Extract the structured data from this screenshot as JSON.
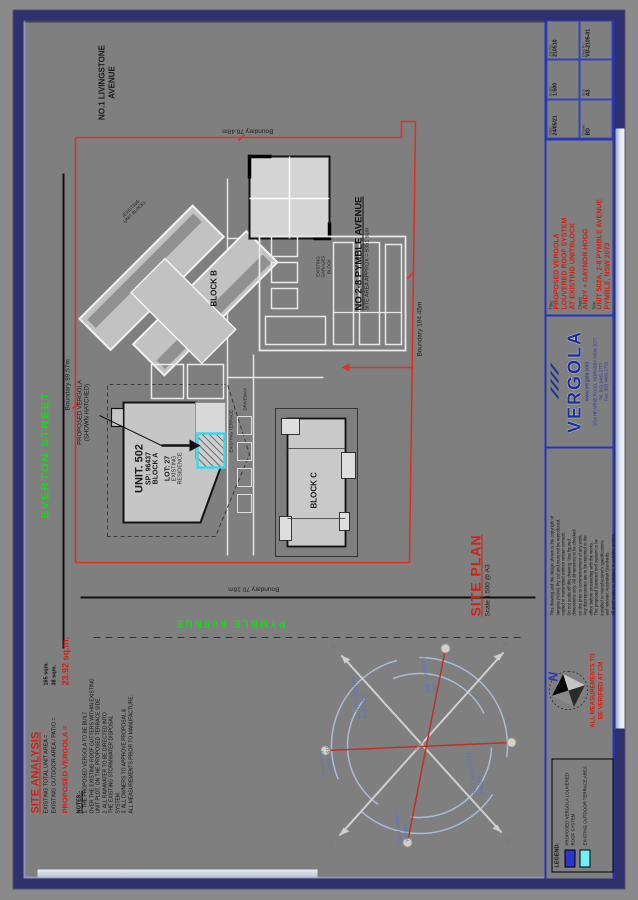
{
  "colors": {
    "red": "#d42015",
    "green": "#17d817",
    "blue": "#2b35c8",
    "cyan": "#49e4f2",
    "navy": "#2e3070"
  },
  "streets": {
    "everton": "EVERTON STREET",
    "pymble": "PYMBLE AVENUE",
    "livingstone_lines": [
      "NO.1 LIVINGSTONE",
      "AVENUE"
    ]
  },
  "boundaries": {
    "top": "Boundary 99.57m",
    "right": "Boundary 76.48m",
    "left": "Boundary 70.16m",
    "bottom": "Boundary 104.45m"
  },
  "plan": {
    "neighbor_title": "NO 2-8 PYMBLE AVENUE",
    "neighbor_sub": "SITE AREA APPROX = 9351 sqm",
    "block_b": "BLOCK B",
    "block_b_sub_lines": [
      "(EXISTING",
      "UNIT BLOCK)"
    ],
    "block_c": "BLOCK C",
    "unit_no": "UNIT. 502",
    "sp": "SP: 96437",
    "block_a": "BLOCK A",
    "lot": "LOT: 27",
    "existing_res_lines": [
      "EXISTING",
      "RESIDENCE"
    ],
    "garages_lines": [
      "EXISTING",
      "GARAGES",
      "BLOCK"
    ],
    "callout_lines": [
      "PROPOSED VERGOLA",
      "(SHOWN HATCHED)"
    ],
    "terrace": "EXISTING TERRACE",
    "driveway": "DRIVEWAY"
  },
  "site_analysis": {
    "heading": "SITE ANALYSIS",
    "row1_label": "EXISTING TOTAL UNIT AREA =",
    "row1_value": "165 sqm.",
    "row2_label": "EXISTING OUTDOOR AREA / PATIO =",
    "row2_value": "38 sqm.",
    "row3_label": "PROPOSED VERGOLA =",
    "row3_value": "23.92 sq.m.",
    "notes_heading": "NOTES:-",
    "notes_lines": [
      "1. THE PROPOSED VERGOLA TO BE BUILT",
      "    OVER THE EXISTING ROOF GUTTERS WITHIN EXISTING",
      "    UNIT PLOT, ON THE PROPOSED TERRACE SIDE.",
      "2. ALL RAINWATER TO BE DIRECTED INTO",
      "    THE EXISTING STORMWATER DISPOSAL",
      "    SYSTEM.",
      "3. ALL OWNERS TO APPROVE PROPOSAL &",
      "    ALL MEASUREMENTS PRIOR TO MANUFACTURE."
    ]
  },
  "site_plan_caption": {
    "title": "SITE PLAN",
    "scale": "Scale 1:500 @ A3"
  },
  "windrose": {
    "labels": [
      "morning\nwinter sun",
      "warm summer\nbreezes",
      "cold winter\nwinds",
      "hot western\nsun",
      "cool southerly\nwinds"
    ],
    "dirs": [
      "NE",
      "NW",
      "SE",
      "SW"
    ]
  },
  "titleblock": {
    "legend_heading": "LEGEND:",
    "legend_items": [
      {
        "label": "PROPOSED VERGOLA LOUVERED ROOF SYSTEM"
      },
      {
        "label": "EXISTING OUTDOOR TERRACE AREA"
      }
    ],
    "north": "N",
    "measure_lines": [
      "ALL MEASUREMENTS TO",
      "BE VERIFIED AT CM"
    ],
    "disclaimer_lines": [
      "This drawing and the design shown is the copyright of",
      "Vergola (NSW) Pty Ltd and must not be reproduced,",
      "copied or transmitted without written consent.",
      "Do not scale off this drawing. Use figured",
      "dimensions only. All dimensions to be checked",
      "on site prior to commencement of any work.",
      "Any discrepancies are to be reported to the",
      "office before proceeding with the works.",
      "The proposed louvered roof system to be",
      "installed to manufacturer's specifications",
      "and relevant Australian Standards.",
      "All stormwater to connect to existing system."
    ],
    "logo": {
      "name": "VERGOLA",
      "web": "www.vergola.com",
      "addr": "2/14 HEARNE ROAD, HORNSBY NSW 2077",
      "tel": "Tel: (02) 9482 2777",
      "fax": "Fax: (02) 9482 2733"
    },
    "title_label": "Title:",
    "title_lines": [
      "PROPOSED VERGOLA",
      "LOUVERED ROOF SYSTEM",
      "AT EXISTING UNITBLOCK"
    ],
    "client_label": "Client:",
    "client": "ANDY + GAYNOR HOGG",
    "site_label": "Site:",
    "site_lines": [
      "UNIT 502A, 2-8 PYMBLE AVENUE",
      "PYMBLE, NSW 2073"
    ],
    "table": [
      {
        "l": "Date:",
        "v": "24/05/21"
      },
      {
        "l": "Scale:",
        "v": "1:500"
      },
      {
        "l": "Job No:",
        "v": "210510"
      },
      {
        "l": "Drawn:",
        "v": "BD"
      },
      {
        "l": "Size:",
        "v": "A3"
      },
      {
        "l": "Dwg No:",
        "v": "VD-2105-01"
      }
    ]
  }
}
